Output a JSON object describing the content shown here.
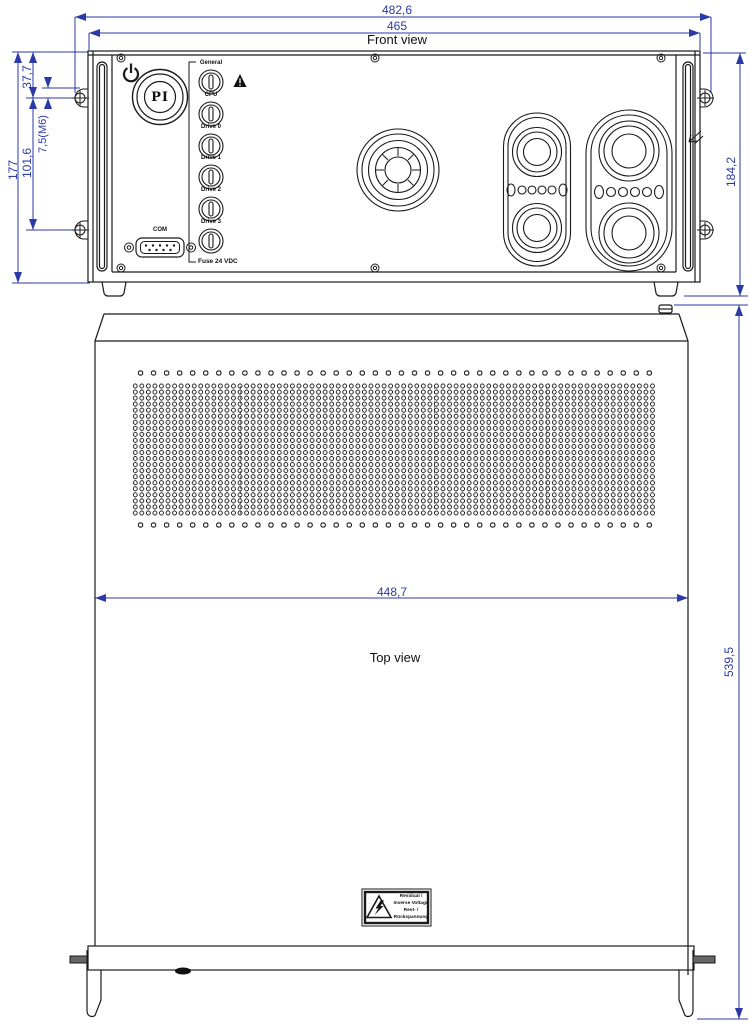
{
  "front": {
    "title": "Front view",
    "dims": {
      "width_outer": "482,6",
      "width_inner": "465",
      "panel_height": "177",
      "hole_top_offset": "37,7",
      "hole_spacing": "101,6",
      "hole_thread": "7,5(M6)",
      "total_height": "184,2"
    },
    "panel": {
      "logo": "PI",
      "leds": [
        "General",
        "CPU",
        "Drive 0",
        "Drive 1",
        "Drive 2",
        "Drive 3"
      ],
      "fuse_label": "Fuse 24 VDC",
      "com_label": "COM"
    }
  },
  "top": {
    "title": "Top view",
    "dims": {
      "width": "448,7",
      "depth": "539,5"
    },
    "warning_label": {
      "lines": [
        "Residual /",
        "Inverse Voltage",
        "Rest- /",
        "Rückspannung"
      ]
    }
  },
  "icons": {
    "power": "standby-power-symbol",
    "warning_small": "triangle-exclamation",
    "hazard": "high-voltage-triangle",
    "logo": "pi-logo-roundel"
  },
  "colors": {
    "dimension_blue": "#2B3AA6",
    "line_black": "#1a1a1a"
  }
}
